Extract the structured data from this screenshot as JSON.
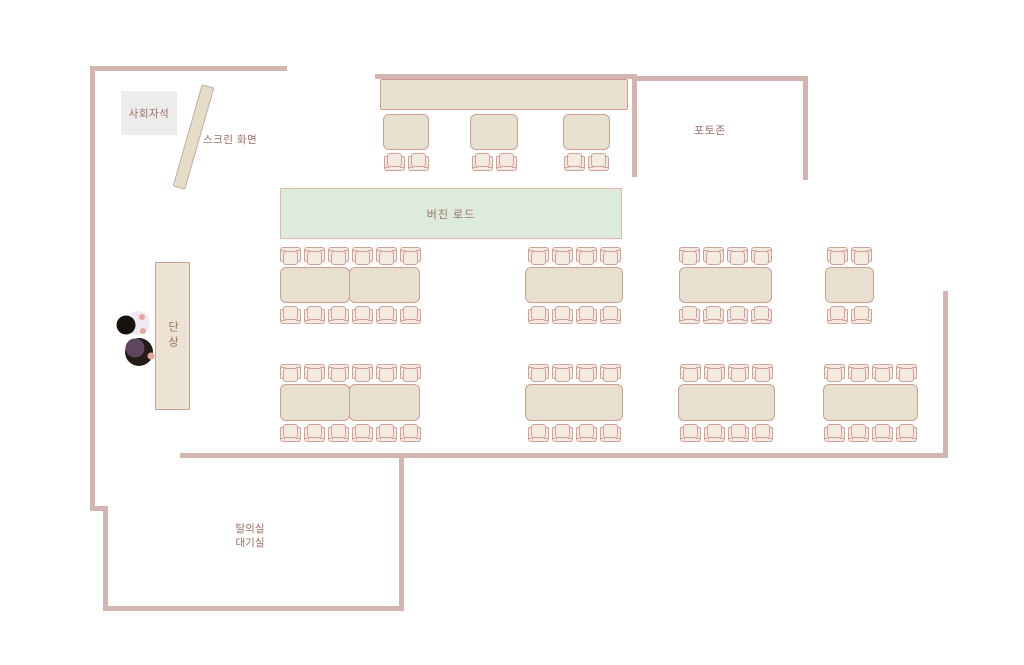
{
  "labels": {
    "mc_seat": "사회자석",
    "screen": "스크린 화면",
    "photo_zone": "포토존",
    "virgin_road": "버진 로드",
    "stage": "단상",
    "dressing_line1": "탈의실",
    "dressing_line2": "대기실"
  },
  "colors": {
    "wall": "#d2b5b1",
    "table_fill": "#e8e0cf",
    "table_border": "#cf9e93",
    "chair_fill": "#f3ebdf",
    "chair_border": "#d2a097",
    "aisle_fill": "#dcebdb",
    "aisle_border": "#e9b7a6",
    "mc_box_fill": "#ececec",
    "screen_fill": "#e6ddc9",
    "stage_fill": "#ece3d3",
    "text": "#9b6d62"
  },
  "floorplan": {
    "walls": [
      {
        "x": 90,
        "y": 66,
        "w": 197,
        "h": 5
      },
      {
        "x": 90,
        "y": 66,
        "w": 5,
        "h": 445
      },
      {
        "x": 90,
        "y": 506,
        "w": 18,
        "h": 5
      },
      {
        "x": 103,
        "y": 506,
        "w": 5,
        "h": 105
      },
      {
        "x": 103,
        "y": 606,
        "w": 301,
        "h": 5
      },
      {
        "x": 399,
        "y": 455,
        "w": 5,
        "h": 156
      },
      {
        "x": 180,
        "y": 453,
        "w": 768,
        "h": 5
      },
      {
        "x": 943,
        "y": 291,
        "w": 5,
        "h": 167
      },
      {
        "x": 375,
        "y": 74,
        "w": 262,
        "h": 5
      },
      {
        "x": 632,
        "y": 74,
        "w": 5,
        "h": 103
      },
      {
        "x": 632,
        "y": 76,
        "w": 176,
        "h": 5
      },
      {
        "x": 803,
        "y": 76,
        "w": 5,
        "h": 104
      }
    ],
    "tables": [
      {
        "id": "head-table",
        "x": 380,
        "y": 79,
        "w": 248,
        "h": 31,
        "halves": 1,
        "chairs_top": 0,
        "chairs_bottom": 0,
        "flat": true
      },
      {
        "id": "head-seat-table-1",
        "x": 383,
        "y": 114,
        "w": 46,
        "h": 36,
        "halves": 1,
        "chairs_top": 0,
        "chairs_bottom": 2
      },
      {
        "id": "head-seat-table-2",
        "x": 470,
        "y": 114,
        "w": 48,
        "h": 36,
        "halves": 1,
        "chairs_top": 0,
        "chairs_bottom": 2
      },
      {
        "id": "head-seat-table-3",
        "x": 563,
        "y": 114,
        "w": 47,
        "h": 36,
        "halves": 1,
        "chairs_top": 0,
        "chairs_bottom": 2
      },
      {
        "id": "guest-table-row1-left",
        "x": 280,
        "y": 267,
        "w": 140,
        "h": 36,
        "halves": 2,
        "chairs_top": 6,
        "chairs_bottom": 6
      },
      {
        "id": "guest-table-row1-mid",
        "x": 525,
        "y": 267,
        "w": 98,
        "h": 36,
        "halves": 1,
        "chairs_top": 4,
        "chairs_bottom": 4
      },
      {
        "id": "guest-table-row1-right",
        "x": 679,
        "y": 267,
        "w": 93,
        "h": 36,
        "halves": 1,
        "chairs_top": 4,
        "chairs_bottom": 4
      },
      {
        "id": "guest-table-row1-far-right",
        "x": 825,
        "y": 267,
        "w": 49,
        "h": 36,
        "halves": 1,
        "chairs_top": 2,
        "chairs_bottom": 2
      },
      {
        "id": "guest-table-row2-left",
        "x": 280,
        "y": 384,
        "w": 140,
        "h": 37,
        "halves": 2,
        "chairs_top": 6,
        "chairs_bottom": 6
      },
      {
        "id": "guest-table-row2-mid",
        "x": 525,
        "y": 384,
        "w": 98,
        "h": 37,
        "halves": 1,
        "chairs_top": 4,
        "chairs_bottom": 4
      },
      {
        "id": "guest-table-row2-right",
        "x": 678,
        "y": 384,
        "w": 97,
        "h": 37,
        "halves": 1,
        "chairs_top": 4,
        "chairs_bottom": 4
      },
      {
        "id": "guest-table-row2-far-right",
        "x": 823,
        "y": 384,
        "w": 95,
        "h": 37,
        "halves": 1,
        "chairs_top": 4,
        "chairs_bottom": 4
      }
    ]
  }
}
